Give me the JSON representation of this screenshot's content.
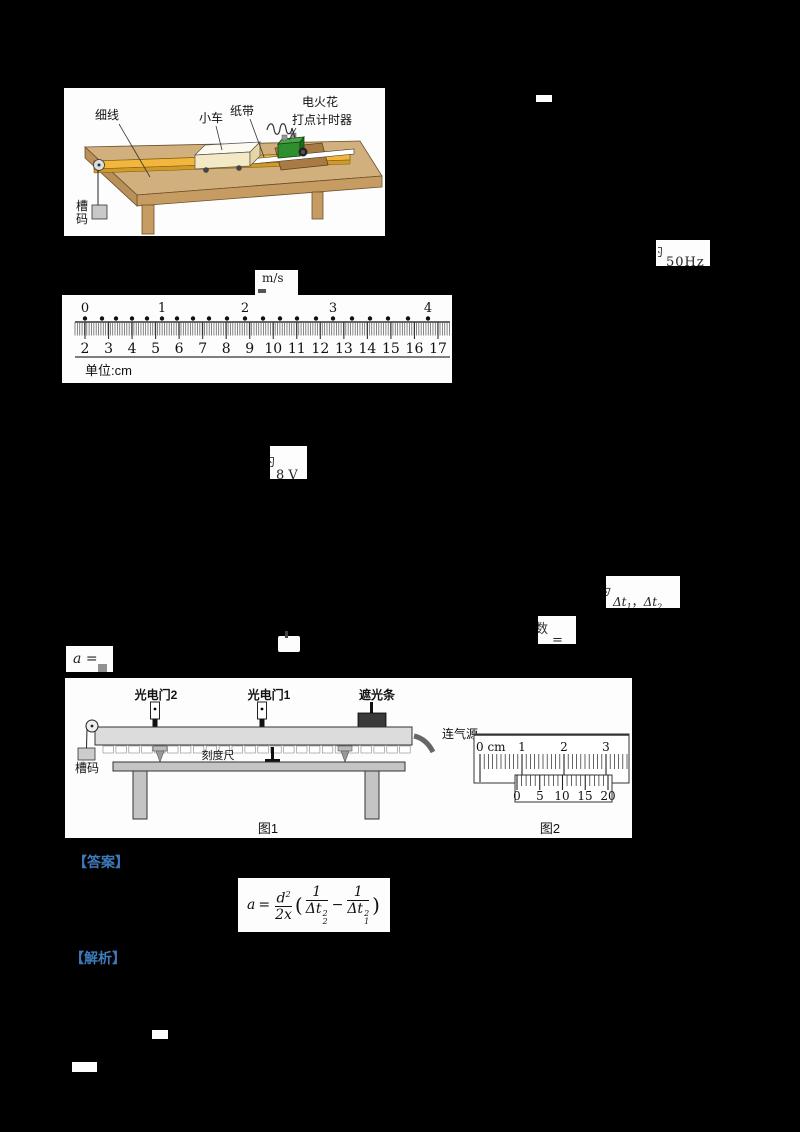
{
  "colors": {
    "background": "#000000",
    "panel": "#fdfdfd",
    "accent_blue": "#3d7ab9",
    "table_tan": "#d2b07e",
    "table_front": "#c69c62",
    "track_yellow": "#f2b63d",
    "timer_green": "#2f8f2f",
    "base_brown": "#aa7a44"
  },
  "figure_cart": {
    "label_string": "细线",
    "label_cart": "小车",
    "label_tape": "纸带",
    "label_timer_line1": "电火花",
    "label_timer_line2": "打点计时器",
    "label_weights_line1": "槽",
    "label_weights_line2": "码"
  },
  "fragments": {
    "freq_prefix": "约",
    "freq": "50Hz",
    "volt_prefix": "约",
    "volt": "8 V",
    "delta_prefix": "为",
    "delta_t1_main": "Δt",
    "delta_t1_sub": "1",
    "delta_comma": "，",
    "delta_t2_main": "Δt",
    "delta_t2_sub": "2",
    "shu_prefix": "数",
    "shu_eq": "=",
    "a_label": "a",
    "a_eq": "="
  },
  "tape_figure": {
    "velocity_unit": "m/s",
    "dot_labels": [
      "0",
      "1",
      "2",
      "3",
      "4"
    ],
    "dot_label_x": [
      23,
      100,
      183,
      271,
      366
    ],
    "dot_x": [
      23,
      40,
      54,
      70,
      85,
      100,
      115,
      131,
      147,
      165,
      183,
      201,
      218,
      235,
      254,
      271,
      290,
      308,
      326,
      346,
      366
    ],
    "ruler_numbers": [
      "2",
      "3",
      "4",
      "5",
      "6",
      "7",
      "8",
      "9",
      "10",
      "11",
      "12",
      "13",
      "14",
      "15",
      "16",
      "17"
    ],
    "unit_label": "单位:cm"
  },
  "figure_track": {
    "label_photogate2": "光电门2",
    "label_photogate1": "光电门1",
    "label_shutter": "遮光条",
    "label_scale": "刻度尺",
    "label_weights": "槽码",
    "label_air": "连气源",
    "caption_fig1": "图1",
    "caption_fig2": "图2"
  },
  "caliper": {
    "main_numbers": [
      "0 cm",
      "1",
      "2",
      "3"
    ],
    "main_number_x": [
      411,
      457,
      499,
      541
    ],
    "vernier_numbers": [
      "0",
      "5",
      "10",
      "15",
      "20"
    ],
    "vernier_number_x": [
      452,
      475,
      497,
      520,
      543
    ]
  },
  "answer_section": {
    "answer_label": "【答案】",
    "analysis_label": "【解析】"
  },
  "formula": {
    "lhs": "a",
    "eq": "=",
    "num_base": "d",
    "num_sup": "2",
    "den": "2x",
    "paren_open": "(",
    "f1_num": "1",
    "f1_base": "Δt",
    "f1_sub": "2",
    "f1_sup": "2",
    "minus": "−",
    "f2_num": "1",
    "f2_base": "Δt",
    "f2_sub": "1",
    "f2_sup": "2",
    "paren_close": ")"
  }
}
